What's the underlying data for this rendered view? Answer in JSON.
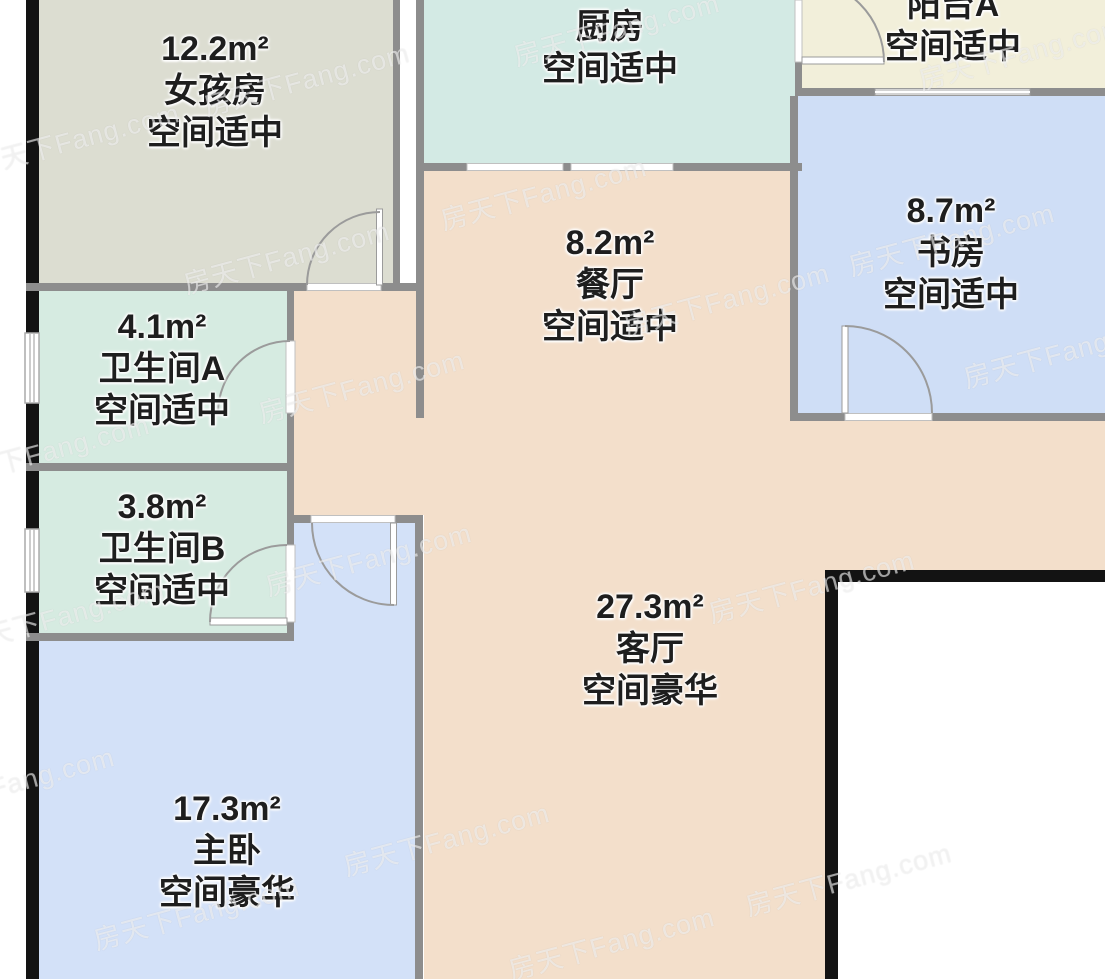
{
  "watermark": "房天下Fang.com",
  "rooms": {
    "girls": {
      "area": "12.2m²",
      "name": "女孩房",
      "status": "空间适中"
    },
    "kitchen": {
      "area": "6.1m²",
      "name": "厨房",
      "status": "空间适中"
    },
    "balcony_a": {
      "area": "",
      "name": "阳台A",
      "status": "空间适中"
    },
    "study": {
      "area": "8.7m²",
      "name": "书房",
      "status": "空间适中"
    },
    "dining": {
      "area": "8.2m²",
      "name": "餐厅",
      "status": "空间适中"
    },
    "bath_a": {
      "area": "4.1m²",
      "name": "卫生间A",
      "status": "空间适中"
    },
    "bath_b": {
      "area": "3.8m²",
      "name": "卫生间B",
      "status": "空间适中"
    },
    "living": {
      "area": "27.3m²",
      "name": "客厅",
      "status": "空间豪华"
    },
    "master": {
      "area": "17.3m²",
      "name": "主卧",
      "status": "空间豪华"
    }
  },
  "colors": {
    "floor_peach": "#f3dfcb",
    "floor_mint_bath": "#d6ebe1",
    "floor_mint_kitchen": "#d3eae4",
    "floor_green_gray": "#dcddd1",
    "floor_blue": "#d3e1f8",
    "floor_yellow": "#f2efda",
    "wall_gray": "#8d8d8d",
    "wall_black": "#131313"
  }
}
